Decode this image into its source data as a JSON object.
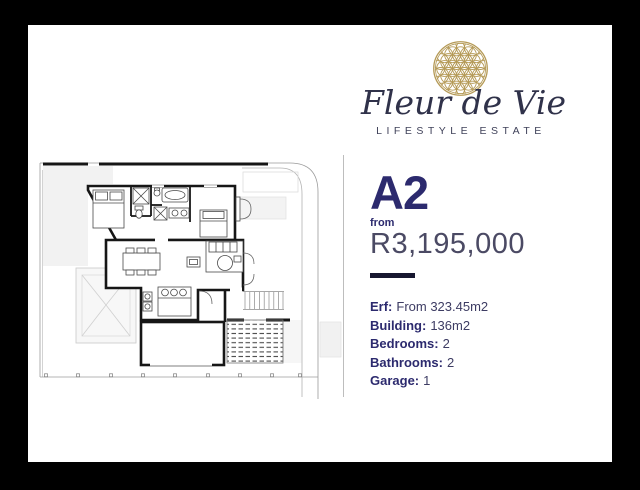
{
  "logo": {
    "brand": "Fleur de Vie",
    "tagline": "LIFESTYLE ESTATE",
    "mark": "flower-of-life-icon",
    "gold": "#b59a57"
  },
  "unit": {
    "code": "A2",
    "price_prefix": "from",
    "price": "R3,195,000"
  },
  "specs": [
    {
      "label": "Erf:",
      "value": "From 323.45m2"
    },
    {
      "label": "Building:",
      "value": "136m2"
    },
    {
      "label": "Bedrooms:",
      "value": "2"
    },
    {
      "label": "Bathrooms:",
      "value": "2"
    },
    {
      "label": "Garage:",
      "value": "1"
    }
  ],
  "colors": {
    "navy": "#2c2a6e",
    "price_grey": "#4b4a64",
    "gold": "#b59a57",
    "background": "#000000",
    "card": "#ffffff"
  }
}
